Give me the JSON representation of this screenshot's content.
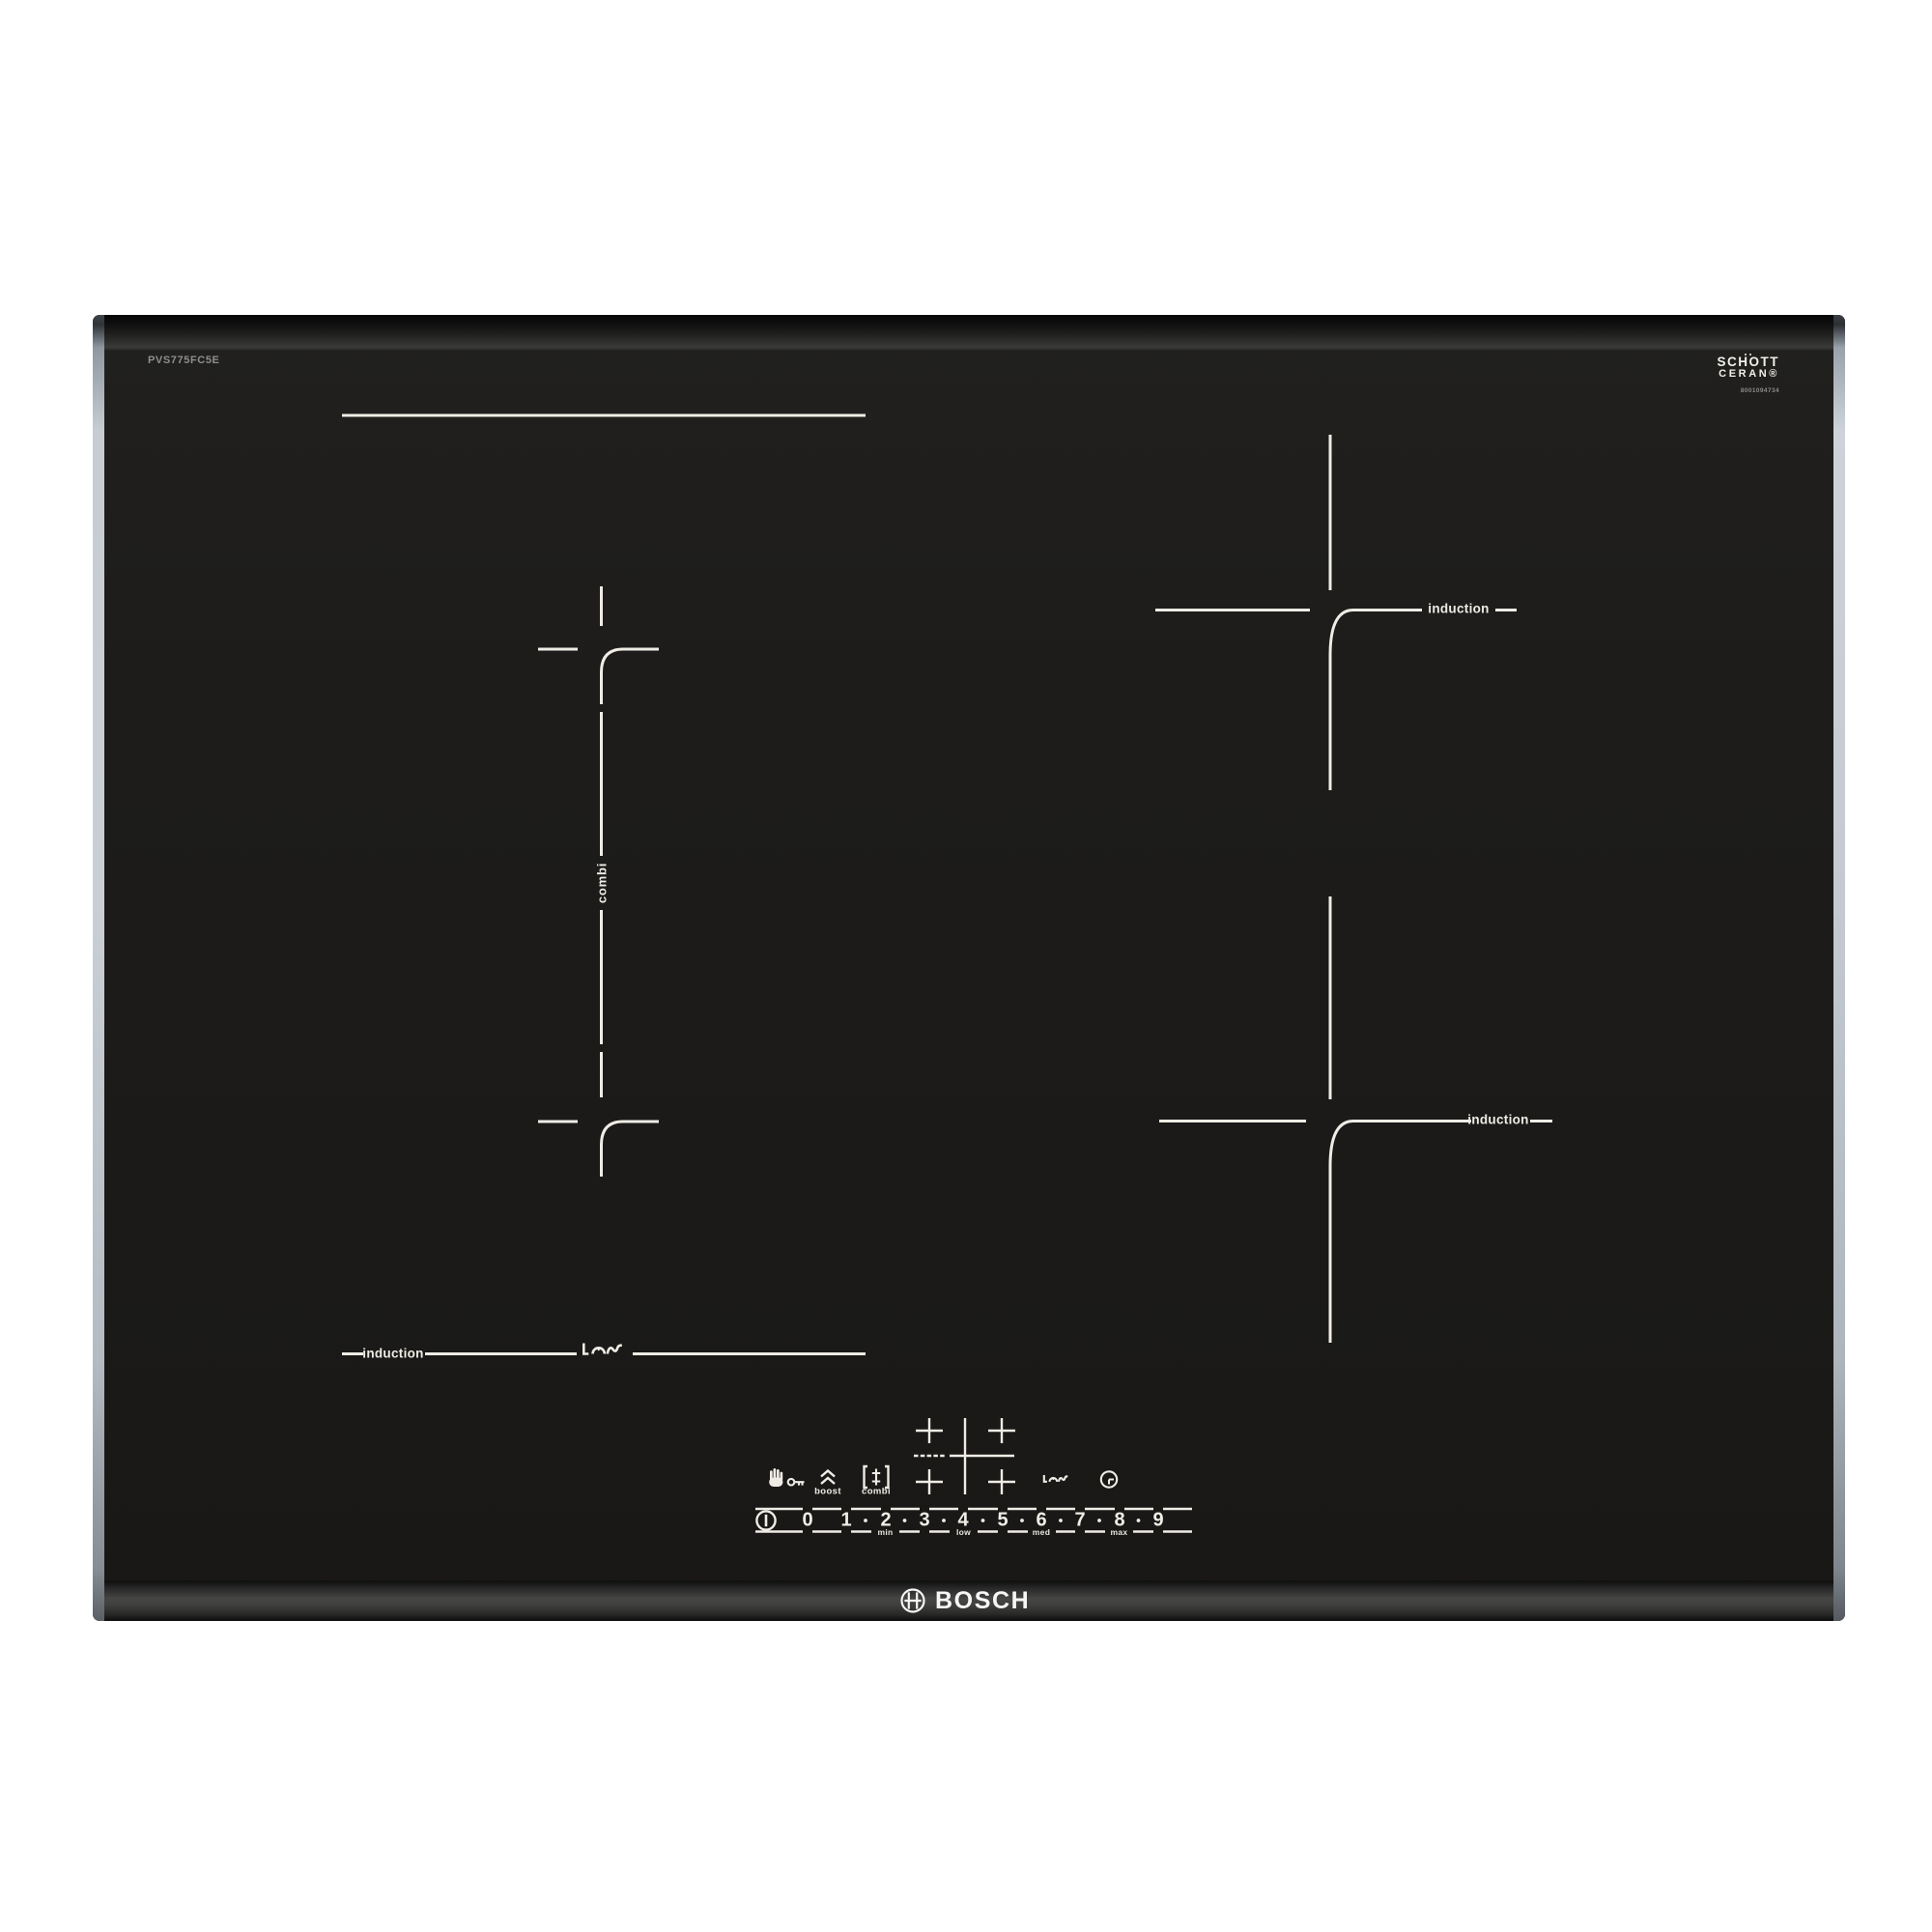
{
  "branding": {
    "bosch": "BOSCH",
    "glass_line1": "SCHOTT",
    "glass_line2": "CERAN®",
    "glass_serial": "8001094734",
    "model": "PVS775FC5E"
  },
  "zones": {
    "back_right_label": "induction",
    "front_right_label": "induction",
    "front_left_label": "induction",
    "left_combi_label": "combi"
  },
  "controls": {
    "boost_label": "boost",
    "combi_label": "combi",
    "levels": [
      "0",
      "1",
      "2",
      "3",
      "4",
      "5",
      "6",
      "7",
      "8",
      "9"
    ],
    "scale": {
      "min": "min",
      "low": "low",
      "med": "med",
      "max": "max"
    },
    "icons": {
      "child_lock": "hand-with-key",
      "boost": "double-chevron-up",
      "combi": "bracket-double-tick",
      "zone_select": "cross-cluster",
      "wipe_protection": "pan-with-wave",
      "timer": "clock",
      "power": "circled-bar"
    }
  },
  "colors": {
    "glass": "#1d1c1a",
    "marking": "#efece5",
    "trim_silver": "#c3c9cf",
    "model_text": "#8f8f8f",
    "page_background": "#ffffff"
  }
}
